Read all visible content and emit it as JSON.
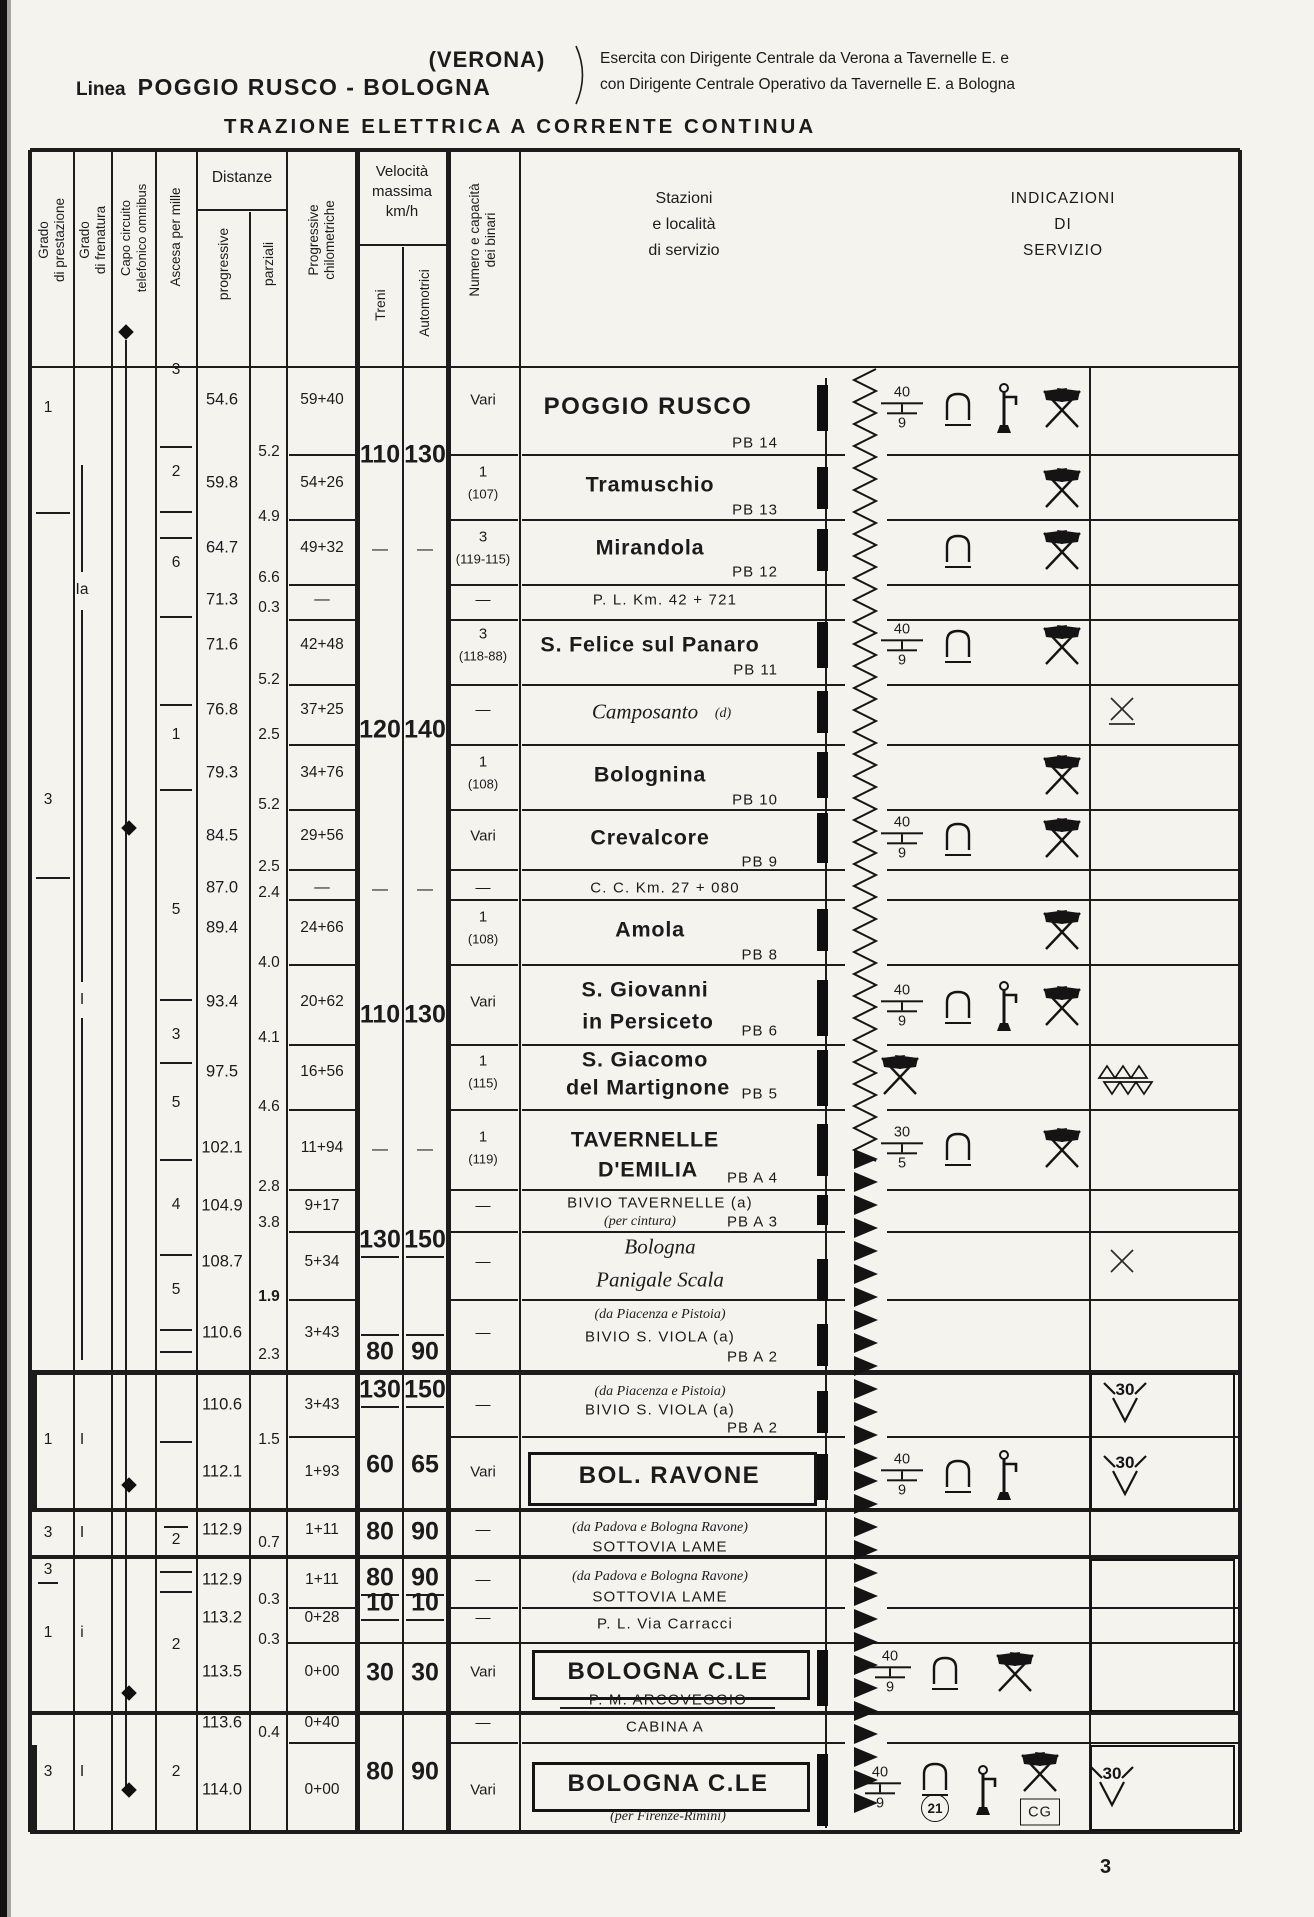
{
  "page": {
    "number": "3"
  },
  "header": {
    "linea_label": "Linea",
    "linea_name": "POGGIO RUSCO - BOLOGNA",
    "via": "(VERONA)",
    "note1": "Esercita con Dirigente Centrale da Verona a Tavernelle E. e",
    "note2": "con Dirigente Centrale Operativo da Tavernelle E. a Bologna",
    "title": "TRAZIONE ELETTRICA A CORRENTE CONTINUA"
  },
  "column_headers": {
    "grado_prestazione": "Grado\ndi prestazione",
    "grado_frenatura": "Grado\ndi frenatura",
    "capo_circuito": "Capo circuito\ntelefonico omnibus",
    "ascesa": "Ascesa per mille",
    "distanze": "Distanze",
    "progressive": "progressive",
    "parziali": "parziali",
    "progressive_km": "Progressive\nchilometriche",
    "velocita": "Velocità\nmassima\nkm/h",
    "treni": "Treni",
    "automotrici": "Automotrici",
    "numero_binari": "Numero e capacità\ndei binari",
    "stazioni": "Stazioni\ne località\ndi servizio",
    "indicazioni": "INDICAZIONI\nDI\nSERVIZIO"
  },
  "grado_prestazione": [
    {
      "v": "1"
    },
    {
      "v": "3"
    },
    {
      "v": "1"
    },
    {
      "v": "3"
    },
    {
      "v": "3",
      "underline": true
    },
    {
      "v": "1"
    },
    {
      "v": "3"
    }
  ],
  "grado_frenatura": [
    {
      "v": "Ia"
    },
    {
      "v": "I"
    },
    {
      "v": "I"
    },
    {
      "v": "I"
    },
    {
      "v": "i"
    },
    {
      "v": "I"
    }
  ],
  "capo_circuito_markers": [
    {
      "type": "diamond"
    },
    {
      "type": "diamond"
    },
    {
      "type": "diamond"
    },
    {
      "type": "diamond"
    },
    {
      "type": "diamond"
    }
  ],
  "ascesa_per_mille": [
    {
      "v": "3"
    },
    {
      "v": "2"
    },
    {
      "v": "6"
    },
    {
      "v": "1"
    },
    {
      "v": "5"
    },
    {
      "v": "3"
    },
    {
      "v": "5"
    },
    {
      "v": "4"
    },
    {
      "v": "5"
    },
    {
      "v": "2",
      "overline": true
    },
    {
      "v": "2"
    },
    {
      "v": "2"
    }
  ],
  "speeds": [
    {
      "treni": "110",
      "automotrici": "130"
    },
    {
      "treni": "—",
      "automotrici": "—"
    },
    {
      "treni": "120",
      "automotrici": "140"
    },
    {
      "treni": "—",
      "automotrici": "—"
    },
    {
      "treni": "110",
      "automotrici": "130"
    },
    {
      "treni": "—",
      "automotrici": "—"
    },
    {
      "treni": "130",
      "automotrici": "150"
    },
    {
      "treni": "80",
      "automotrici": "90"
    },
    {
      "treni": "130",
      "automotrici": "150"
    },
    {
      "treni": "60",
      "automotrici": "65"
    },
    {
      "treni": "80",
      "automotrici": "90"
    },
    {
      "treni": "80",
      "automotrici": "90"
    },
    {
      "treni": "10",
      "automotrici": "10"
    },
    {
      "treni": "30",
      "automotrici": "30"
    },
    {
      "treni": "80",
      "automotrici": "90"
    }
  ],
  "stations": [
    {
      "prog": "54.6",
      "parz": "5.2",
      "km": "59+40",
      "bin1": "Vari",
      "name": "POGGIO RUSCO",
      "pb": "PB 14",
      "style": "big",
      "icons": [
        {
          "type": "weight-limit",
          "top": "40",
          "bottom": "9"
        },
        {
          "type": "arch"
        },
        {
          "type": "water-crane"
        },
        {
          "type": "crossed-flags"
        }
      ]
    },
    {
      "prog": "59.8",
      "parz": "4.9",
      "km": "54+26",
      "bin1": "1",
      "bin2": "(107)",
      "name": "Tramuschio",
      "pb": "PB 13",
      "style": "med",
      "icons": [
        {
          "type": "crossed-flags"
        }
      ]
    },
    {
      "prog": "64.7",
      "parz": "6.6",
      "km": "49+32",
      "bin1": "3",
      "bin2": "(119-115)",
      "name": "Mirandola",
      "pb": "PB 12",
      "style": "med",
      "icons": [
        {
          "type": "arch"
        },
        {
          "type": "crossed-flags"
        }
      ]
    },
    {
      "prog": "71.3",
      "parz": "0.3",
      "km": "—",
      "bin1": "—",
      "name": "P. L. Km. 42 + 721",
      "style": "rule",
      "icons": []
    },
    {
      "prog": "71.6",
      "parz": "5.2",
      "km": "42+48",
      "bin1": "3",
      "bin2": "(118-88)",
      "name": "S. Felice sul Panaro",
      "pb": "PB 11",
      "style": "med",
      "icons": [
        {
          "type": "weight-limit",
          "top": "40",
          "bottom": "9"
        },
        {
          "type": "arch"
        },
        {
          "type": "crossed-flags"
        }
      ]
    },
    {
      "prog": "76.8",
      "parz": "2.5",
      "km": "37+25",
      "bin1": "—",
      "name": "Camposanto",
      "suffix": "(d)",
      "style": "italic",
      "icons": [],
      "right_icon": {
        "type": "crossing-x",
        "underline": true
      }
    },
    {
      "prog": "79.3",
      "parz": "5.2",
      "km": "34+76",
      "bin1": "1",
      "bin2": "(108)",
      "name": "Bolognina",
      "pb": "PB 10",
      "style": "med",
      "icons": [
        {
          "type": "crossed-flags"
        }
      ]
    },
    {
      "prog": "84.5",
      "parz": "2.5",
      "km": "29+56",
      "bin1": "Vari",
      "name": "Crevalcore",
      "pb": "PB 9",
      "style": "med",
      "icons": [
        {
          "type": "weight-limit",
          "top": "40",
          "bottom": "9"
        },
        {
          "type": "arch"
        },
        {
          "type": "crossed-flags"
        }
      ]
    },
    {
      "prog": "87.0",
      "parz": "2.4",
      "km": "—",
      "bin1": "—",
      "name": "C. C. Km. 27 + 080",
      "style": "rule",
      "icons": []
    },
    {
      "prog": "89.4",
      "parz": "4.0",
      "km": "24+66",
      "bin1": "1",
      "bin2": "(108)",
      "name": "Amola",
      "pb": "PB 8",
      "style": "med",
      "icons": [
        {
          "type": "crossed-flags"
        }
      ]
    },
    {
      "prog": "93.4",
      "parz": "4.1",
      "km": "20+62",
      "bin1": "Vari",
      "name": "S. Giovanni",
      "name2": "in Persiceto",
      "pb": "PB 6",
      "style": "med2",
      "icons": [
        {
          "type": "weight-limit",
          "top": "40",
          "bottom": "9"
        },
        {
          "type": "arch"
        },
        {
          "type": "water-crane"
        },
        {
          "type": "crossed-flags"
        }
      ]
    },
    {
      "prog": "97.5",
      "parz": "4.6",
      "km": "16+56",
      "bin1": "1",
      "bin2": "(115)",
      "name": "S. Giacomo",
      "name2": "del Martignone",
      "pb": "PB 5",
      "style": "med2",
      "icons": [
        {
          "type": "crossed-flags"
        }
      ],
      "right_icon": {
        "type": "triangles"
      }
    },
    {
      "prog": "102.1",
      "parz": "2.8",
      "km": "11+94",
      "bin1": "1",
      "bin2": "(119)",
      "name": "TAVERNELLE",
      "name2": "D'EMILIA",
      "pb": "PB A 4",
      "style": "med2",
      "icons": [
        {
          "type": "weight-limit",
          "top": "30",
          "bottom": "5"
        },
        {
          "type": "arch"
        },
        {
          "type": "crossed-flags"
        }
      ]
    },
    {
      "prog": "104.9",
      "parz": "3.8",
      "km": "9+17",
      "bin1": "—",
      "name": "BIVIO TAVERNELLE (a)",
      "name2": "(per cintura)",
      "pb": "PB A 3",
      "style": "bivio2",
      "icons": []
    },
    {
      "prog": "108.7",
      "parz": "1.9",
      "parz_bold": true,
      "km": "5+34",
      "bin1": "—",
      "name": "Bologna",
      "name2": "Panigale Scala",
      "style": "italic2",
      "icons": [],
      "right_icon": {
        "type": "crossing-x"
      }
    },
    {
      "prog": "110.6",
      "parz": "2.3",
      "km": "3+43",
      "bin1": "—",
      "note": "(da Piacenza e Pistoia)",
      "name": "BIVIO S. VIOLA (a)",
      "pb": "PB A 2",
      "style": "bivio",
      "icons": []
    },
    {
      "prog": "110.6",
      "parz": "1.5",
      "km": "3+43",
      "bin1": "—",
      "note": "(da Piacenza e Pistoia)",
      "name": "BIVIO S. VIOLA (a)",
      "pb": "PB A 2",
      "style": "bivio",
      "icons": [],
      "right_icon": {
        "type": "speed-limit-v",
        "value": "30"
      }
    },
    {
      "prog": "112.1",
      "km": "1+93",
      "bin1": "Vari",
      "name": "BOL. RAVONE",
      "style": "boxed",
      "icons": [
        {
          "type": "weight-limit",
          "top": "40",
          "bottom": "9"
        },
        {
          "type": "arch"
        },
        {
          "type": "water-crane"
        }
      ],
      "right_icon": {
        "type": "speed-limit-v",
        "value": "30"
      }
    },
    {
      "prog": "112.9",
      "parz": "0.7",
      "km": "1+11",
      "bin1": "—",
      "note": "(da Padova e Bologna Ravone)",
      "name": "SOTTOVIA LAME",
      "style": "bivio",
      "icons": []
    },
    {
      "prog": "112.9",
      "parz": "0.3",
      "km": "1+11",
      "bin1": "—",
      "note": "(da Padova e Bologna Ravone)",
      "name": "SOTTOVIA LAME",
      "style": "bivio",
      "icons": []
    },
    {
      "prog": "113.2",
      "parz": "0.3",
      "km": "0+28",
      "bin1": "—",
      "name": "P. L. Via Carracci",
      "style": "rule",
      "icons": []
    },
    {
      "prog": "113.5",
      "km": "0+00",
      "bin1": "Vari",
      "name": "BOLOGNA C.LE",
      "sub": "P. M. ARCOVEGGIO",
      "style": "boxed",
      "icons": [
        {
          "type": "weight-limit",
          "top": "40",
          "bottom": "9"
        },
        {
          "type": "arch"
        },
        {
          "type": "crossed-flags"
        }
      ]
    },
    {
      "prog": "113.6",
      "parz": "0.4",
      "km": "0+40",
      "bin1": "—",
      "name": "CABINA A",
      "style": "rule",
      "icons": []
    },
    {
      "prog": "114.0",
      "km": "0+00",
      "bin1": "Vari",
      "name": "BOLOGNA C.LE",
      "sub": "(per Firenze-Rimini)",
      "style": "boxed",
      "icons": [
        {
          "type": "weight-limit",
          "top": "40",
          "bottom": "9"
        },
        {
          "type": "arch",
          "badge_circle": "21"
        },
        {
          "type": "water-crane"
        },
        {
          "type": "crossed-flags",
          "badge_box": "CG"
        }
      ],
      "right_icon": {
        "type": "speed-limit-v",
        "value": "30"
      }
    }
  ]
}
